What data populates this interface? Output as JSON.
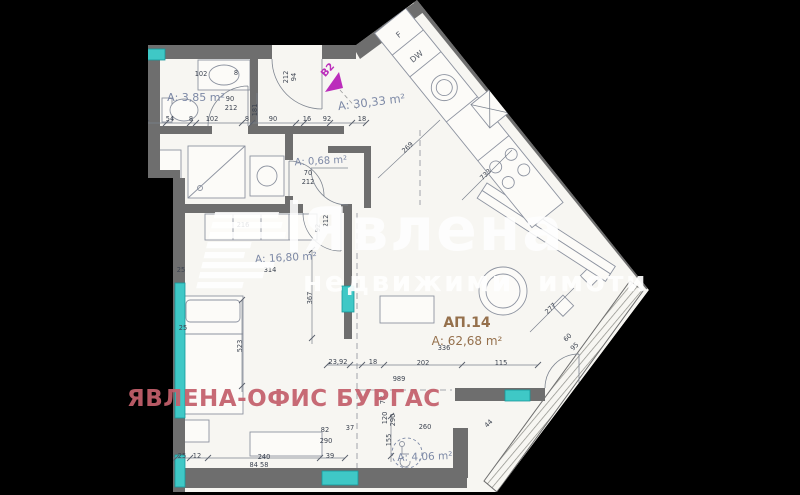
{
  "colors": {
    "background": "#000000",
    "plan_fill": "#f7f6f2",
    "wall": "#6e6e6e",
    "wall_dark": "#4f4f4f",
    "line": "#7e8590",
    "dim_text": "#3c4350",
    "label_blue": "#7d89a6",
    "label_brown": "#95704c",
    "window_teal": "#3fc8c6",
    "window_edge": "#17999b",
    "stamp_pink": "#c4606c",
    "marker_magenta": "#bb2dbb",
    "watermark_white": "#ffffff"
  },
  "watermark": {
    "brand": "Явлена",
    "tagline": "недвижими имоти"
  },
  "overlay": {
    "office_stamp": "ЯВЛЕНА-ОФИС БУРГАС"
  },
  "entrance": {
    "unit_marker": "B2"
  },
  "appliances": {
    "fridge": "F",
    "dishwasher": "DW"
  },
  "room_labels": [
    {
      "t": "А: 3,85 m²",
      "x": 196,
      "y": 101,
      "s": 11,
      "c": "label_blue",
      "r": 0
    },
    {
      "t": "А: 30,33 m²",
      "x": 372,
      "y": 106,
      "s": 11.5,
      "c": "label_blue",
      "r": -7
    },
    {
      "t": "А: 0,68 m²",
      "x": 321,
      "y": 164,
      "s": 10,
      "c": "label_blue",
      "r": -3
    },
    {
      "t": "А: 16,80 m²",
      "x": 286,
      "y": 261,
      "s": 10.5,
      "c": "label_blue",
      "r": -3
    },
    {
      "t": "АП.14",
      "x": 467,
      "y": 327,
      "s": 14,
      "c": "label_brown",
      "r": 0,
      "w": "bold"
    },
    {
      "t": "А: 62,68 m²",
      "x": 467,
      "y": 345,
      "s": 12,
      "c": "label_brown",
      "r": 0
    },
    {
      "t": "А: 4,06 m²",
      "x": 425,
      "y": 460,
      "s": 10.5,
      "c": "label_blue",
      "r": -2
    }
  ],
  "dimension_labels": [
    {
      "t": "25",
      "x": 144,
      "y": 121
    },
    {
      "t": "54",
      "x": 170,
      "y": 121
    },
    {
      "t": "8",
      "x": 191,
      "y": 121
    },
    {
      "t": "102",
      "x": 212,
      "y": 121
    },
    {
      "t": "8",
      "x": 247,
      "y": 121
    },
    {
      "t": "90",
      "x": 273,
      "y": 121
    },
    {
      "t": "16",
      "x": 307,
      "y": 121
    },
    {
      "t": "92",
      "x": 327,
      "y": 121
    },
    {
      "t": "18",
      "x": 362,
      "y": 121
    },
    {
      "t": "102",
      "x": 201,
      "y": 76
    },
    {
      "t": "8",
      "x": 236,
      "y": 75
    },
    {
      "t": "90",
      "x": 230,
      "y": 101
    },
    {
      "t": "212",
      "x": 231,
      "y": 110
    },
    {
      "t": "94",
      "x": 296,
      "y": 77,
      "r": -90
    },
    {
      "t": "212",
      "x": 288,
      "y": 77,
      "r": -90
    },
    {
      "t": "181",
      "x": 257,
      "y": 110,
      "r": -90
    },
    {
      "t": "70",
      "x": 308,
      "y": 175
    },
    {
      "t": "212",
      "x": 308,
      "y": 184
    },
    {
      "t": "92",
      "x": 320,
      "y": 228,
      "r": -90
    },
    {
      "t": "212",
      "x": 328,
      "y": 221,
      "r": -90
    },
    {
      "t": "216",
      "x": 243,
      "y": 227
    },
    {
      "t": "314",
      "x": 270,
      "y": 272
    },
    {
      "t": "367",
      "x": 312,
      "y": 298,
      "r": -90
    },
    {
      "t": "523",
      "x": 242,
      "y": 346,
      "r": -90
    },
    {
      "t": "269",
      "x": 409,
      "y": 149,
      "r": -44
    },
    {
      "t": "733",
      "x": 487,
      "y": 176,
      "r": -44
    },
    {
      "t": "277",
      "x": 552,
      "y": 310,
      "r": -44
    },
    {
      "t": "60",
      "x": 569,
      "y": 339,
      "r": -44
    },
    {
      "t": "95",
      "x": 576,
      "y": 348,
      "r": -44
    },
    {
      "t": "336",
      "x": 444,
      "y": 350
    },
    {
      "t": "23,92",
      "x": 338,
      "y": 364
    },
    {
      "t": "18",
      "x": 373,
      "y": 364
    },
    {
      "t": "202",
      "x": 423,
      "y": 365
    },
    {
      "t": "115",
      "x": 501,
      "y": 365
    },
    {
      "t": "989",
      "x": 399,
      "y": 381
    },
    {
      "t": "78",
      "x": 385,
      "y": 400,
      "r": -90
    },
    {
      "t": "120",
      "x": 387,
      "y": 418,
      "r": -90
    },
    {
      "t": "290",
      "x": 395,
      "y": 420,
      "r": -90
    },
    {
      "t": "82",
      "x": 325,
      "y": 432
    },
    {
      "t": "290",
      "x": 326,
      "y": 443
    },
    {
      "t": "37",
      "x": 350,
      "y": 430
    },
    {
      "t": "155",
      "x": 391,
      "y": 440,
      "r": -90
    },
    {
      "t": "260",
      "x": 425,
      "y": 429
    },
    {
      "t": "44",
      "x": 490,
      "y": 425,
      "r": -44
    },
    {
      "t": "25",
      "x": 181,
      "y": 272
    },
    {
      "t": "25",
      "x": 183,
      "y": 330
    },
    {
      "t": "25",
      "x": 182,
      "y": 458
    },
    {
      "t": "12",
      "x": 197,
      "y": 458
    },
    {
      "t": "240",
      "x": 264,
      "y": 459
    },
    {
      "t": "39",
      "x": 330,
      "y": 458
    },
    {
      "t": "84 58",
      "x": 259,
      "y": 467
    }
  ]
}
